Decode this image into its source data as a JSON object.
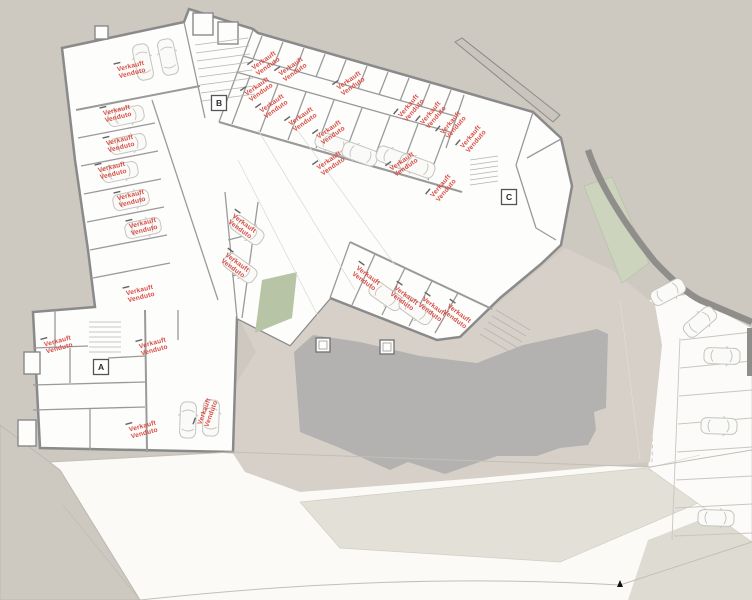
{
  "plan": {
    "title": "underground-garage-floor-plan",
    "sold_label": {
      "line1": "Verkauft",
      "line2": "Venduto"
    },
    "stair_cores": [
      {
        "letter": "A",
        "x": 101,
        "y": 367
      },
      {
        "letter": "B",
        "x": 219,
        "y": 103
      },
      {
        "letter": "C",
        "x": 509,
        "y": 197
      }
    ],
    "sold_units": [
      {
        "x": 131,
        "y": 68,
        "r": -14
      },
      {
        "x": 117,
        "y": 112,
        "r": -14
      },
      {
        "x": 120,
        "y": 142,
        "r": -14
      },
      {
        "x": 112,
        "y": 169,
        "r": -14
      },
      {
        "x": 131,
        "y": 197,
        "r": -14
      },
      {
        "x": 143,
        "y": 225,
        "r": -14
      },
      {
        "x": 140,
        "y": 292,
        "r": -14
      },
      {
        "x": 243,
        "y": 225,
        "r": 36
      },
      {
        "x": 236,
        "y": 264,
        "r": 36
      },
      {
        "x": 265,
        "y": 62,
        "r": -35
      },
      {
        "x": 292,
        "y": 68,
        "r": -35
      },
      {
        "x": 258,
        "y": 88,
        "r": -35
      },
      {
        "x": 350,
        "y": 82,
        "r": -35
      },
      {
        "x": 273,
        "y": 105,
        "r": -35
      },
      {
        "x": 302,
        "y": 118,
        "r": -35
      },
      {
        "x": 330,
        "y": 131,
        "r": -35
      },
      {
        "x": 330,
        "y": 162,
        "r": -35
      },
      {
        "x": 403,
        "y": 163,
        "r": -35
      },
      {
        "x": 410,
        "y": 107,
        "r": -50
      },
      {
        "x": 432,
        "y": 114,
        "r": -50
      },
      {
        "x": 452,
        "y": 124,
        "r": -50
      },
      {
        "x": 472,
        "y": 138,
        "r": -50
      },
      {
        "x": 442,
        "y": 187,
        "r": -50
      },
      {
        "x": 367,
        "y": 277,
        "r": 36
      },
      {
        "x": 405,
        "y": 297,
        "r": 36
      },
      {
        "x": 433,
        "y": 308,
        "r": 36
      },
      {
        "x": 458,
        "y": 315,
        "r": 36
      },
      {
        "x": 58,
        "y": 343,
        "r": -15
      },
      {
        "x": 153,
        "y": 345,
        "r": -15
      },
      {
        "x": 143,
        "y": 428,
        "r": -15
      },
      {
        "x": 206,
        "y": 412,
        "r": -70
      }
    ],
    "cars": [
      {
        "x": 143,
        "y": 62,
        "r": -12
      },
      {
        "x": 168,
        "y": 57,
        "r": -12
      },
      {
        "x": 126,
        "y": 116,
        "r": 78
      },
      {
        "x": 128,
        "y": 144,
        "r": 78
      },
      {
        "x": 120,
        "y": 172,
        "r": 78
      },
      {
        "x": 131,
        "y": 200,
        "r": 78
      },
      {
        "x": 143,
        "y": 228,
        "r": 78
      },
      {
        "x": 333,
        "y": 144,
        "r": -70
      },
      {
        "x": 360,
        "y": 154,
        "r": -70
      },
      {
        "x": 394,
        "y": 158,
        "r": -70
      },
      {
        "x": 417,
        "y": 166,
        "r": -70
      },
      {
        "x": 188,
        "y": 420,
        "r": 2
      },
      {
        "x": 211,
        "y": 418,
        "r": 2
      },
      {
        "x": 386,
        "y": 296,
        "r": 125
      },
      {
        "x": 416,
        "y": 310,
        "r": 125
      },
      {
        "x": 247,
        "y": 230,
        "r": 126
      },
      {
        "x": 240,
        "y": 268,
        "r": 126
      },
      {
        "x": 668,
        "y": 292,
        "r": 62
      },
      {
        "x": 700,
        "y": 322,
        "r": 50
      },
      {
        "x": 722,
        "y": 356,
        "r": 92
      },
      {
        "x": 719,
        "y": 426,
        "r": 92
      },
      {
        "x": 716,
        "y": 518,
        "r": 92
      }
    ],
    "north_marker": {
      "x": 620,
      "y": 584
    },
    "colors": {
      "sold_text": "#d84a42",
      "hill": "#cdc8c0",
      "plan_fill": "#fdfdfc",
      "wall": "#8a8a8a",
      "mass": "#b3b2b0",
      "courtyard": "#d6d0c8",
      "grass": "#b7c4a6",
      "grass_light": "#ccd4bd",
      "road_white": "#fbfaf7"
    }
  }
}
